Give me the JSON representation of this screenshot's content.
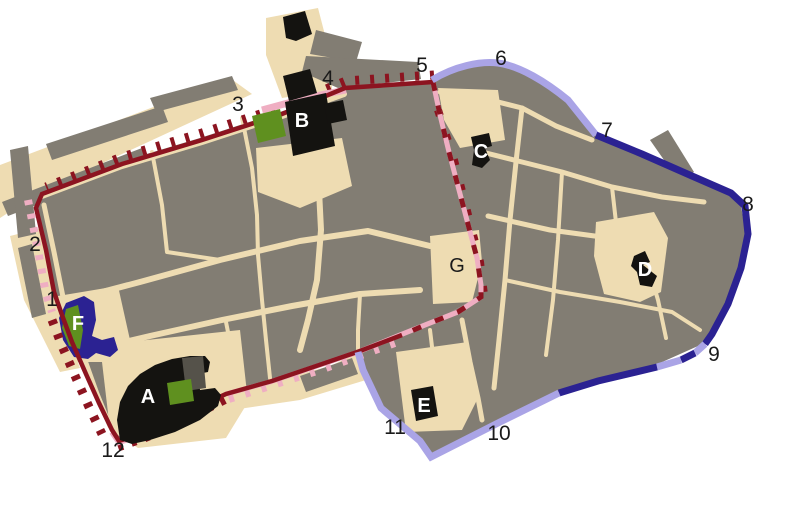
{
  "map": {
    "description": "City map with walls in four phase colors, numbered gates 1-12 and lettered sites A-G",
    "colors": {
      "background": "#ffffff",
      "street": "#eedcb2",
      "block": "#827d73",
      "wall_red": "#8c1420",
      "wall_pink": "#efaec2",
      "wall_navy": "#2b2292",
      "wall_lavender": "#aaa4e6",
      "building_black": "#141310",
      "tower_gray": "#55524a",
      "green": "#5f901f",
      "label_dark": "#1a1a1a",
      "label_light": "#ffffff"
    },
    "numbers": [
      {
        "label": "1"
      },
      {
        "label": "2"
      },
      {
        "label": "3"
      },
      {
        "label": "4"
      },
      {
        "label": "5"
      },
      {
        "label": "6"
      },
      {
        "label": "7"
      },
      {
        "label": "8"
      },
      {
        "label": "9"
      },
      {
        "label": "10"
      },
      {
        "label": "11"
      },
      {
        "label": "12"
      }
    ],
    "letters": [
      {
        "label": "A"
      },
      {
        "label": "B"
      },
      {
        "label": "C"
      },
      {
        "label": "D"
      },
      {
        "label": "E"
      },
      {
        "label": "F"
      },
      {
        "label": "G"
      }
    ]
  }
}
